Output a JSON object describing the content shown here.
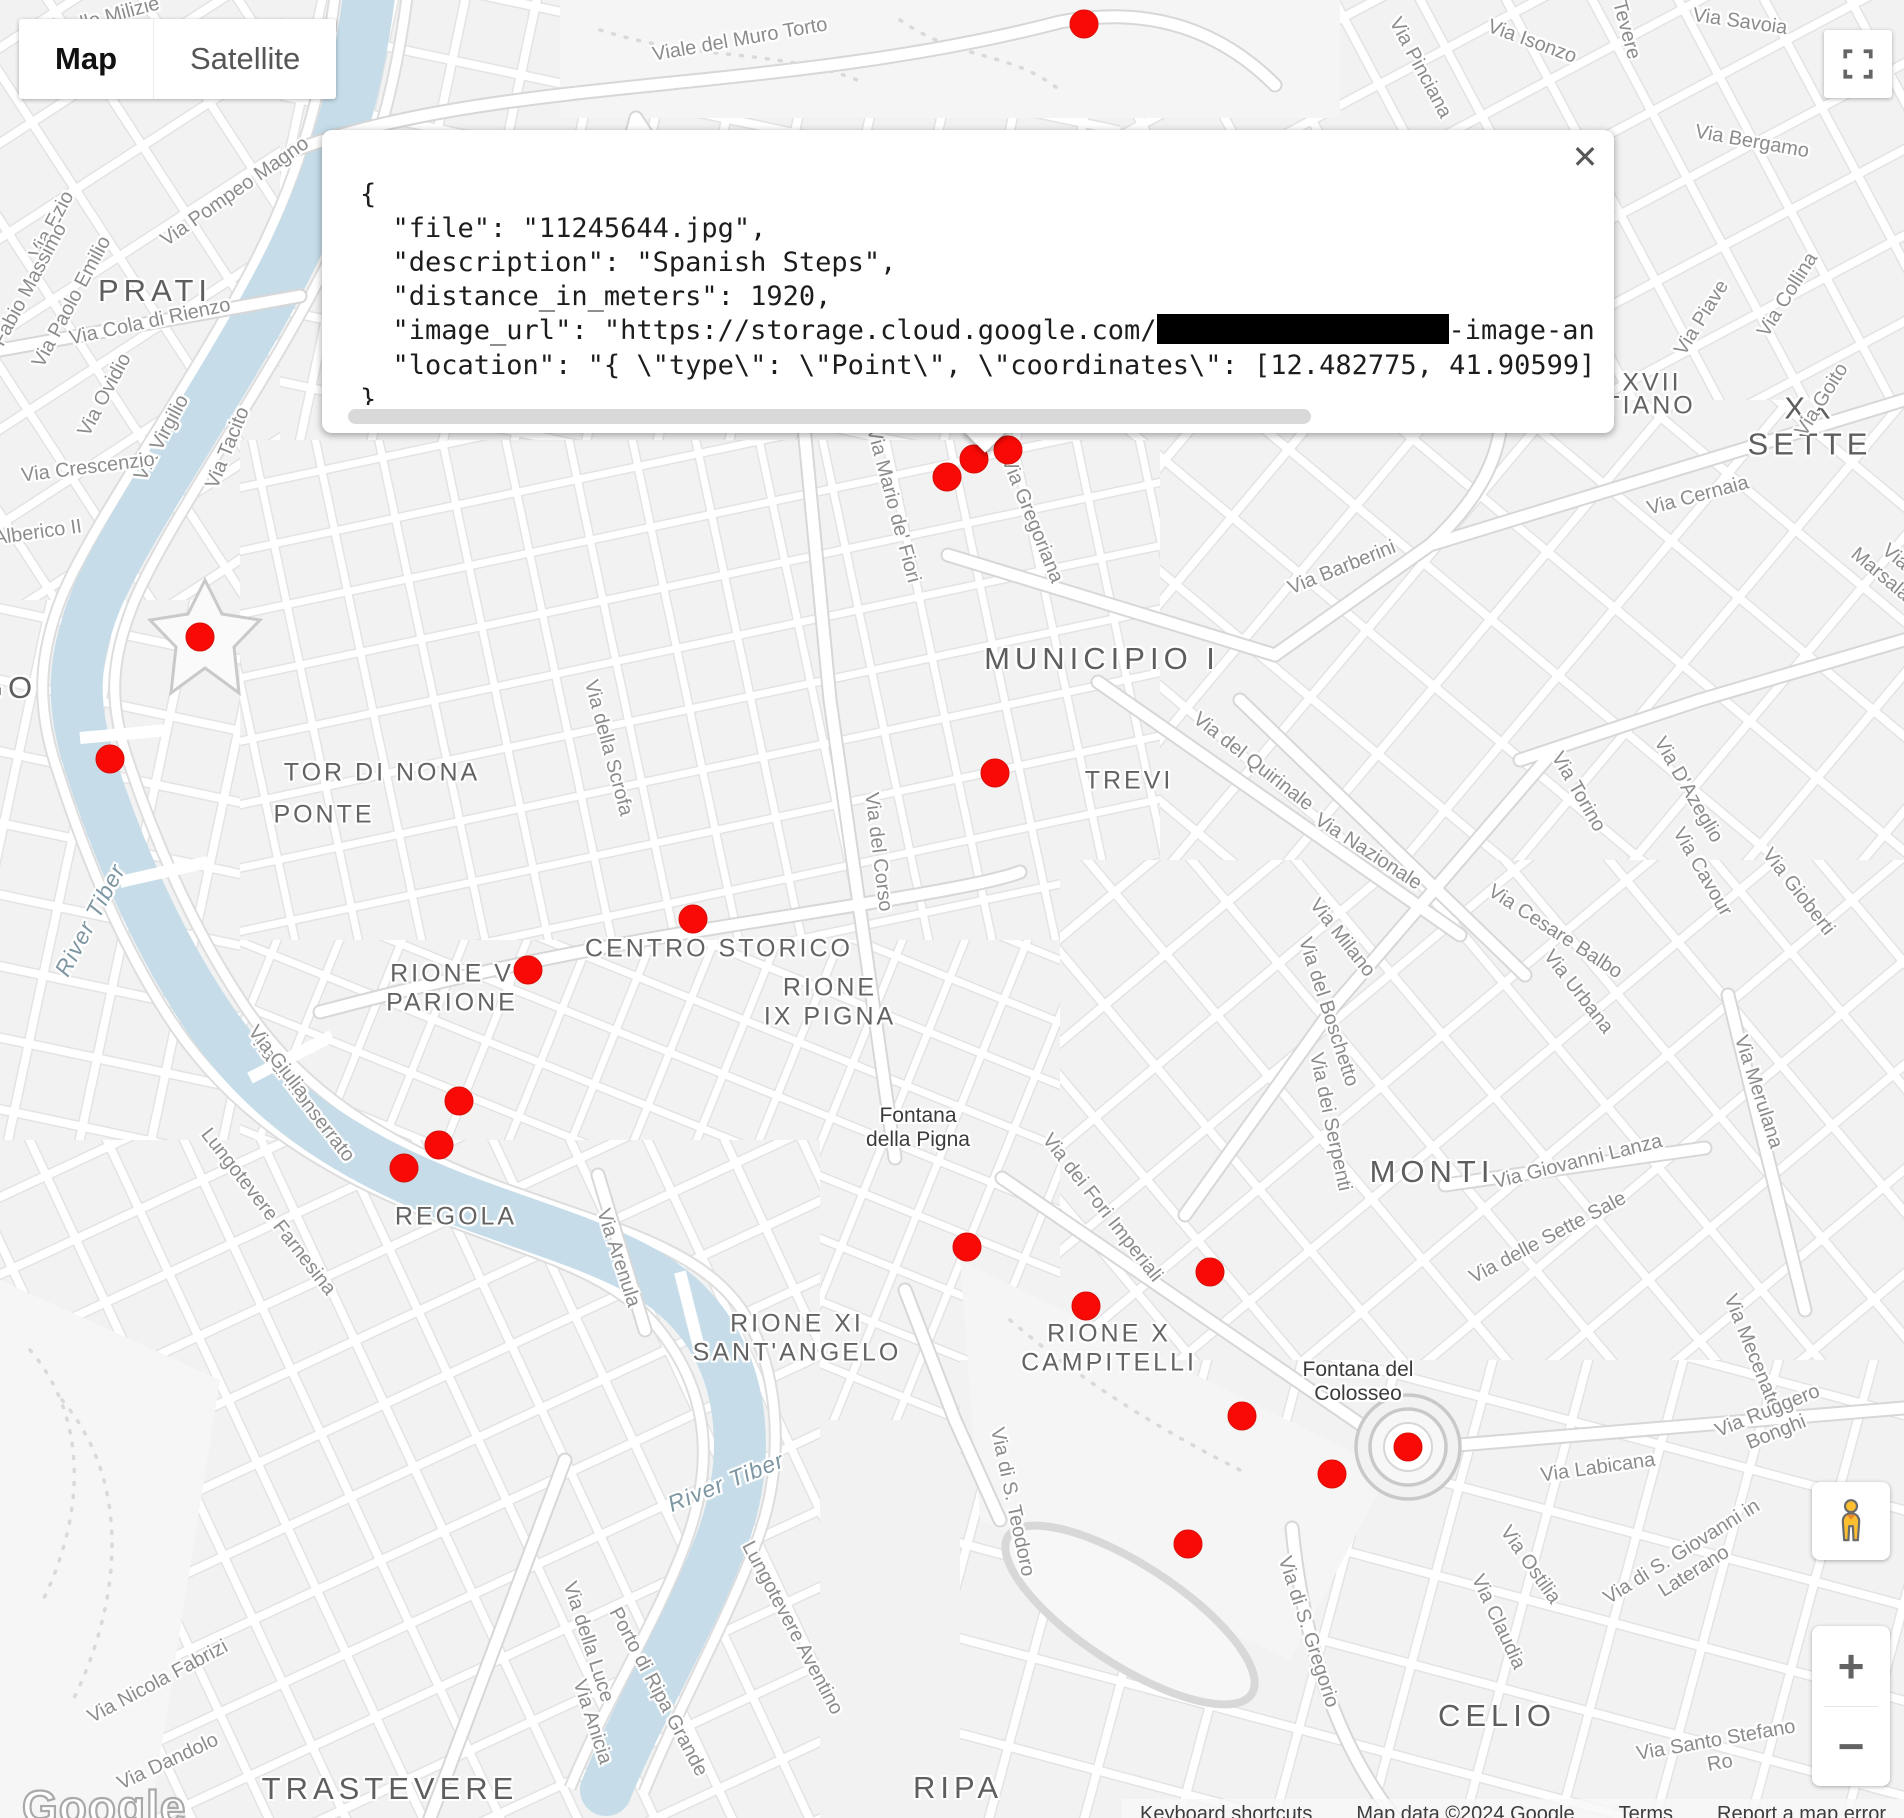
{
  "map_controls": {
    "map_label": "Map",
    "satellite_label": "Satellite",
    "zoom_in": "+",
    "zoom_out": "−",
    "close": "✕"
  },
  "info_window": {
    "lines_before": [
      "{",
      "  \"file\": \"11245644.jpg\",",
      "  \"description\": \"Spanish Steps\",",
      "  \"distance_in_meters\": 1920,"
    ],
    "image_url_prefix": "  \"image_url\": \"https://storage.cloud.google.com/",
    "image_url_suffix": "-image-an",
    "lines_after": [
      "  \"location\": \"{ \\\"type\\\": \\\"Point\\\", \\\"coordinates\\\": [12.482775, 41.90599] }",
      "}"
    ]
  },
  "watermark": "Google",
  "attribution": {
    "keyboard_shortcuts": "Keyboard shortcuts",
    "map_data": "Map data ©2024 Google",
    "terms": "Terms",
    "report": "Report a map error"
  },
  "colors": {
    "marker": "#fa0a06",
    "water": "#c6dde9",
    "pegman": "#fdbe2f"
  },
  "markers": [
    {
      "x": 1084,
      "y": 24
    },
    {
      "x": 1008,
      "y": 450
    },
    {
      "x": 974,
      "y": 459
    },
    {
      "x": 947,
      "y": 477
    },
    {
      "x": 200,
      "y": 637
    },
    {
      "x": 110,
      "y": 759
    },
    {
      "x": 995,
      "y": 773
    },
    {
      "x": 693,
      "y": 919
    },
    {
      "x": 528,
      "y": 970
    },
    {
      "x": 459,
      "y": 1101
    },
    {
      "x": 439,
      "y": 1145
    },
    {
      "x": 404,
      "y": 1168
    },
    {
      "x": 967,
      "y": 1247
    },
    {
      "x": 1210,
      "y": 1272
    },
    {
      "x": 1086,
      "y": 1306
    },
    {
      "x": 1242,
      "y": 1416
    },
    {
      "x": 1408,
      "y": 1447
    },
    {
      "x": 1332,
      "y": 1474
    },
    {
      "x": 1188,
      "y": 1544
    }
  ],
  "map_labels": [
    {
      "text": "PRATI",
      "x": 155,
      "y": 291,
      "rot": 0,
      "cls": "district-xl"
    },
    {
      "text": "MUNICIPIO I",
      "x": 1102,
      "y": 659,
      "rot": 0,
      "cls": "district-xl"
    },
    {
      "text": "MONTI",
      "x": 1432,
      "y": 1172,
      "rot": 0,
      "cls": "district-xl"
    },
    {
      "text": "CELIO",
      "x": 1497,
      "y": 1716,
      "rot": 0,
      "cls": "district-xl"
    },
    {
      "text": "TRASTEVERE",
      "x": 390,
      "y": 1789,
      "rot": 0,
      "cls": "district-xl"
    },
    {
      "text": "RIPA",
      "x": 958,
      "y": 1788,
      "rot": 0,
      "cls": "district-xl"
    },
    {
      "text": "GO",
      "x": 8,
      "y": 688,
      "rot": 0,
      "cls": "district-xl"
    },
    {
      "text": "XX SETTE",
      "x": 1810,
      "y": 426,
      "rot": 0,
      "cls": "district-xl"
    },
    {
      "text": "XVII",
      "x": 1652,
      "y": 383,
      "rot": 0,
      "cls": "district"
    },
    {
      "text": "TIANO",
      "x": 1650,
      "y": 406,
      "rot": 0,
      "cls": "district"
    },
    {
      "text": "TOR DI NONA",
      "x": 382,
      "y": 773,
      "rot": 0,
      "cls": "district"
    },
    {
      "text": "PONTE",
      "x": 324,
      "y": 815,
      "rot": 0,
      "cls": "district"
    },
    {
      "text": "TREVI",
      "x": 1129,
      "y": 781,
      "rot": 0,
      "cls": "district"
    },
    {
      "text": "CENTRO STORICO",
      "x": 719,
      "y": 949,
      "rot": 0,
      "cls": "district"
    },
    {
      "text": "RIONE V\nPARIONE",
      "x": 452,
      "y": 988,
      "rot": 0,
      "cls": "district"
    },
    {
      "text": "RIONE\nIX PIGNA",
      "x": 830,
      "y": 1002,
      "rot": 0,
      "cls": "district"
    },
    {
      "text": "REGOLA",
      "x": 456,
      "y": 1217,
      "rot": 0,
      "cls": "district"
    },
    {
      "text": "RIONE XI\nSANT'ANGELO",
      "x": 797,
      "y": 1338,
      "rot": 0,
      "cls": "district"
    },
    {
      "text": "RIONE X\nCAMPITELLI",
      "x": 1109,
      "y": 1348,
      "rot": 0,
      "cls": "district"
    },
    {
      "text": "Fontana\ndella Pigna",
      "x": 918,
      "y": 1128,
      "rot": 0,
      "cls": "poi"
    },
    {
      "text": "Fontana del\nColosseo",
      "x": 1358,
      "y": 1382,
      "rot": 0,
      "cls": "poi"
    },
    {
      "text": "River Tiber",
      "x": 90,
      "y": 920,
      "rot": -62,
      "cls": "water"
    },
    {
      "text": "River Tiber",
      "x": 726,
      "y": 1482,
      "rot": -22,
      "cls": "water"
    },
    {
      "text": "Viale del Muro Torto",
      "x": 740,
      "y": 40,
      "rot": -10,
      "cls": "street"
    },
    {
      "text": "lle Milizie",
      "x": 120,
      "y": 14,
      "rot": -15,
      "cls": "street"
    },
    {
      "text": "Via Pinciana",
      "x": 1420,
      "y": 68,
      "rot": 62,
      "cls": "street"
    },
    {
      "text": "Via Isonzo",
      "x": 1532,
      "y": 42,
      "rot": 20,
      "cls": "street"
    },
    {
      "text": "Tevere",
      "x": 1626,
      "y": 30,
      "rot": 75,
      "cls": "street"
    },
    {
      "text": "Via Savoia",
      "x": 1740,
      "y": 22,
      "rot": 8,
      "cls": "street"
    },
    {
      "text": "Via Bergamo",
      "x": 1752,
      "y": 142,
      "rot": 10,
      "cls": "street"
    },
    {
      "text": "Via Piave",
      "x": 1702,
      "y": 318,
      "rot": -58,
      "cls": "street"
    },
    {
      "text": "Via Collina",
      "x": 1788,
      "y": 295,
      "rot": -58,
      "cls": "street"
    },
    {
      "text": "Via Goito",
      "x": 1822,
      "y": 400,
      "rot": -58,
      "cls": "street"
    },
    {
      "text": "Via Cernaia",
      "x": 1698,
      "y": 496,
      "rot": -15,
      "cls": "street"
    },
    {
      "text": "Via Marsala",
      "x": 1888,
      "y": 566,
      "rot": 40,
      "cls": "street"
    },
    {
      "text": "Via Ezio",
      "x": 52,
      "y": 225,
      "rot": -62,
      "cls": "street"
    },
    {
      "text": "Via Pompeo Magno",
      "x": 235,
      "y": 192,
      "rot": -35,
      "cls": "street"
    },
    {
      "text": "Fabio Massimo",
      "x": 30,
      "y": 285,
      "rot": -62,
      "cls": "street"
    },
    {
      "text": "Via Paolo Emilio",
      "x": 72,
      "y": 302,
      "rot": -62,
      "cls": "street"
    },
    {
      "text": "Via Cola di Rienzo",
      "x": 150,
      "y": 322,
      "rot": -12,
      "cls": "street"
    },
    {
      "text": "Via Ovidio",
      "x": 105,
      "y": 395,
      "rot": -62,
      "cls": "street"
    },
    {
      "text": "Via Virgilio",
      "x": 162,
      "y": 438,
      "rot": -62,
      "cls": "street"
    },
    {
      "text": "Via Tacito",
      "x": 228,
      "y": 448,
      "rot": -68,
      "cls": "street"
    },
    {
      "text": "Via Crescenzio",
      "x": 88,
      "y": 468,
      "rot": -7,
      "cls": "street"
    },
    {
      "text": "a Alberico II",
      "x": 30,
      "y": 534,
      "rot": -8,
      "cls": "street"
    },
    {
      "text": "Via Mario de' Fiori",
      "x": 893,
      "y": 505,
      "rot": 75,
      "cls": "street"
    },
    {
      "text": "Via Gregoriana",
      "x": 1032,
      "y": 520,
      "rot": 68,
      "cls": "street"
    },
    {
      "text": "Via Barberini",
      "x": 1342,
      "y": 568,
      "rot": -22,
      "cls": "street"
    },
    {
      "text": "Via del Quirinale",
      "x": 1253,
      "y": 762,
      "rot": 38,
      "cls": "street"
    },
    {
      "text": "Via della Scrofa",
      "x": 608,
      "y": 748,
      "rot": 75,
      "cls": "street"
    },
    {
      "text": "Via del Corso",
      "x": 878,
      "y": 852,
      "rot": 83,
      "cls": "street"
    },
    {
      "text": "Via Nazionale",
      "x": 1368,
      "y": 852,
      "rot": 33,
      "cls": "street"
    },
    {
      "text": "Via Torino",
      "x": 1578,
      "y": 792,
      "rot": 60,
      "cls": "street"
    },
    {
      "text": "Via D'Azeglio",
      "x": 1688,
      "y": 790,
      "rot": 60,
      "cls": "street"
    },
    {
      "text": "Via Cavour",
      "x": 1702,
      "y": 872,
      "rot": 60,
      "cls": "street"
    },
    {
      "text": "Via Gioberti",
      "x": 1798,
      "y": 892,
      "rot": 52,
      "cls": "street"
    },
    {
      "text": "Via Milano",
      "x": 1342,
      "y": 938,
      "rot": 52,
      "cls": "street"
    },
    {
      "text": "Via Cesare Balbo",
      "x": 1555,
      "y": 932,
      "rot": 33,
      "cls": "street"
    },
    {
      "text": "Via Urbana",
      "x": 1578,
      "y": 992,
      "rot": 52,
      "cls": "street"
    },
    {
      "text": "Via del Boschetto",
      "x": 1328,
      "y": 1012,
      "rot": 72,
      "cls": "street"
    },
    {
      "text": "Via dei Serpenti",
      "x": 1330,
      "y": 1122,
      "rot": 78,
      "cls": "street"
    },
    {
      "text": "Via Giovanni Lanza",
      "x": 1578,
      "y": 1162,
      "rot": -14,
      "cls": "street"
    },
    {
      "text": "Via delle Sette Sale",
      "x": 1548,
      "y": 1238,
      "rot": -28,
      "cls": "street"
    },
    {
      "text": "Via Merulana",
      "x": 1758,
      "y": 1092,
      "rot": 72,
      "cls": "street"
    },
    {
      "text": "Via Mecenate",
      "x": 1752,
      "y": 1352,
      "rot": 68,
      "cls": "street"
    },
    {
      "text": "Via Ruggero Bonghi",
      "x": 1772,
      "y": 1422,
      "rot": -22,
      "cls": "street"
    },
    {
      "text": "Via Labicana",
      "x": 1598,
      "y": 1468,
      "rot": -8,
      "cls": "street"
    },
    {
      "text": "Via di Monserrato",
      "x": 302,
      "y": 1098,
      "rot": 52,
      "cls": "street"
    },
    {
      "text": "Via Giulia",
      "x": 278,
      "y": 1062,
      "rot": 52,
      "cls": "street"
    },
    {
      "text": "Lungotevere Farnesina",
      "x": 268,
      "y": 1212,
      "rot": 52,
      "cls": "street"
    },
    {
      "text": "Via Arenula",
      "x": 618,
      "y": 1258,
      "rot": 72,
      "cls": "street"
    },
    {
      "text": "Via dei Fori Imperiali",
      "x": 1102,
      "y": 1208,
      "rot": 52,
      "cls": "street"
    },
    {
      "text": "Via di S. Teodoro",
      "x": 1012,
      "y": 1502,
      "rot": 78,
      "cls": "street"
    },
    {
      "text": "Via della Luce",
      "x": 588,
      "y": 1642,
      "rot": 72,
      "cls": "street"
    },
    {
      "text": "Via Anicia",
      "x": 592,
      "y": 1722,
      "rot": 72,
      "cls": "street"
    },
    {
      "text": "Via Nicola Fabrizi",
      "x": 158,
      "y": 1682,
      "rot": -28,
      "cls": "street"
    },
    {
      "text": "Via Dandolo",
      "x": 168,
      "y": 1762,
      "rot": -25,
      "cls": "street"
    },
    {
      "text": "Porto di Ripa Grande",
      "x": 658,
      "y": 1692,
      "rot": 62,
      "cls": "street"
    },
    {
      "text": "Lungotevere Aventino",
      "x": 792,
      "y": 1628,
      "rot": 62,
      "cls": "street"
    },
    {
      "text": "Via di S. Gregorio",
      "x": 1308,
      "y": 1632,
      "rot": 72,
      "cls": "street"
    },
    {
      "text": "Via Claudia",
      "x": 1498,
      "y": 1622,
      "rot": 65,
      "cls": "street"
    },
    {
      "text": "Via Ostilia",
      "x": 1530,
      "y": 1565,
      "rot": 55,
      "cls": "street"
    },
    {
      "text": "Via di S. Giovanni in Laterano",
      "x": 1688,
      "y": 1562,
      "rot": -32,
      "cls": "street"
    },
    {
      "text": "Via Santo Stefano Ro",
      "x": 1718,
      "y": 1752,
      "rot": -10,
      "cls": "street"
    }
  ]
}
